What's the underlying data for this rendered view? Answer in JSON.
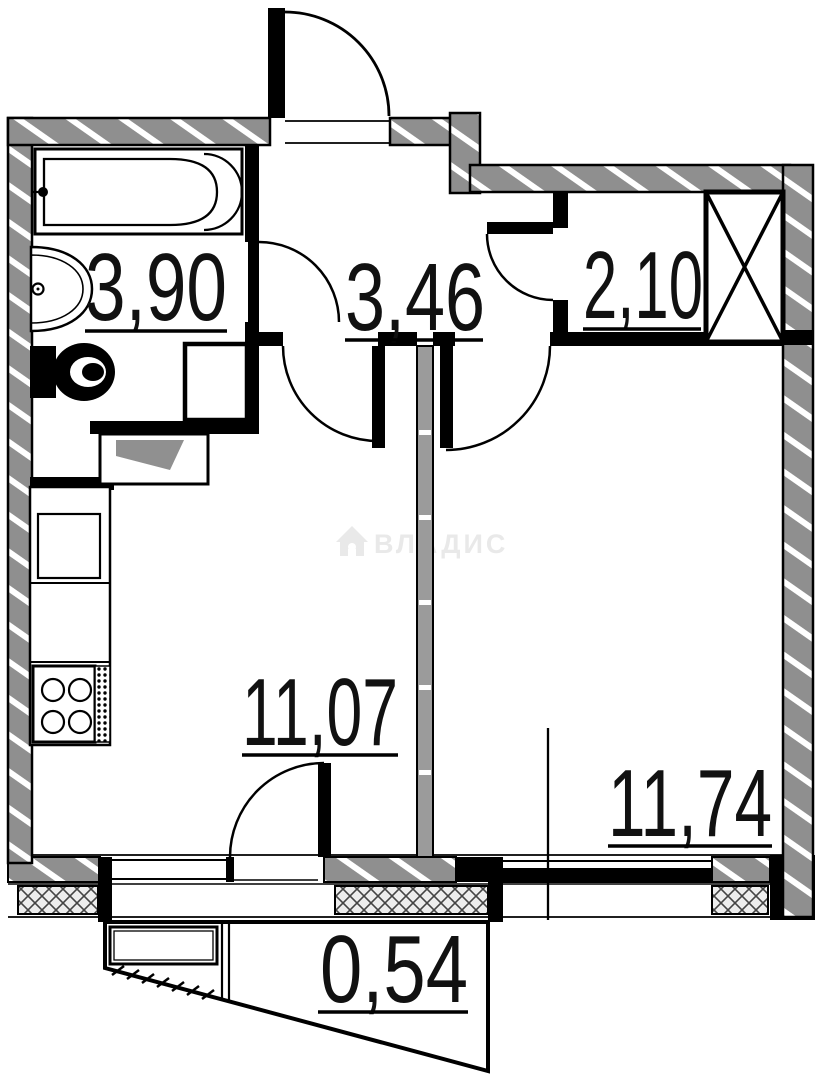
{
  "plan": {
    "type": "apartment-floor-plan",
    "watermark": {
      "text": "ВЛАДИС",
      "icon": "house-icon",
      "color": "#e9e9e9"
    },
    "rooms": {
      "bathroom": {
        "area": "3,90"
      },
      "hallway": {
        "area": "3,46"
      },
      "closet": {
        "area": "2,10"
      },
      "living_kitchen": {
        "area": "11,07"
      },
      "bedroom": {
        "area": "11,74"
      },
      "balcony": {
        "area": "0,54"
      }
    },
    "icons": [
      "bathtub-icon",
      "sink-icon",
      "toilet-icon",
      "washing-machine-icon",
      "kitchen-counter",
      "kitchen-sink-icon",
      "stove-icon",
      "ventilation-shaft-icon",
      "entrance-door-icon",
      "bathroom-door-icon",
      "closet-door-icon",
      "living-room-door-icon",
      "bedroom-door-icon",
      "balcony-door-icon",
      "house-icon"
    ],
    "colors": {
      "wall_fill": "#8f8f8f",
      "line": "#000000",
      "background": "#ffffff",
      "window_hatch": "#ededed",
      "watermark": "#e9e9e9"
    }
  }
}
